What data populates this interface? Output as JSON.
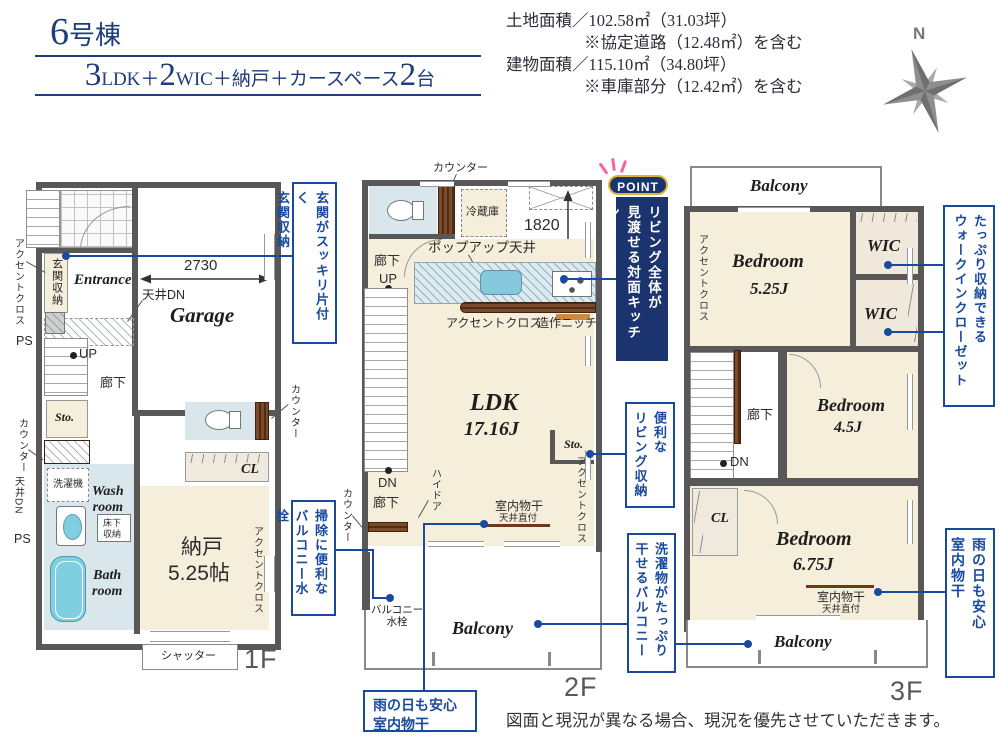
{
  "title": {
    "num": "6",
    "suffix": "号棟"
  },
  "plan": {
    "n1": "3",
    "t1": "LDK＋",
    "n2": "2",
    "t2": "WIC＋納戸＋カースペース",
    "n3": "2",
    "t3": "台"
  },
  "areas": {
    "land": "土地面積／102.58㎡（31.03坪）",
    "land_note": "※協定道路（12.48㎡）を含む",
    "bldg": "建物面積／115.10㎡（34.80坪）",
    "bldg_note": "※車庫部分（12.42㎡）を含む"
  },
  "compass": {
    "n": "N"
  },
  "f1": {
    "floor": "1F",
    "accent_entrance": "アクセントクロス",
    "genkan": "玄関収納",
    "entrance": "Entrance",
    "dim2730": "2730",
    "tenjo_dn": "天井DN",
    "garage": "Garage",
    "ps1": "PS",
    "up": "UP",
    "roka": "廊下",
    "sto": "Sto.",
    "counter_l": "カウンター",
    "counter_r": "カウンター",
    "tenjo_dn_l": "天井DN",
    "ps2": "PS",
    "sentakuki": "洗濯機",
    "wash": "Wash\nroom",
    "yukashita": "床下\n収納",
    "bath": "Bath\nroom",
    "cl": "CL",
    "nando": "納戸",
    "nando_size": "5.25帖",
    "accent_nando": "アクセントクロス",
    "shutter": "シャッター"
  },
  "f2": {
    "floor": "2F",
    "counter_t": "カウンター",
    "reizoko": "冷蔵庫",
    "dim1820": "1820",
    "popup": "ポップアップ天井",
    "roka_t": "廊下",
    "up": "UP",
    "accent_kitchen": "アクセントクロス",
    "niche": "造作ニッチ",
    "ldk": "LDK",
    "ldk_size": "17.16J",
    "sto": "Sto.",
    "accent_r": "アクセントクロス",
    "dn": "DN",
    "roka_b": "廊下",
    "counter_l": "カウンター",
    "hidoor": "ハイドア",
    "monohoshi": "室内物干",
    "tenjo": "天井直付",
    "suisen": "バルコニー\n水栓",
    "balcony": "Balcony"
  },
  "f3": {
    "floor": "3F",
    "balcony_t": "Balcony",
    "accent": "アクセントクロス",
    "bed1": "Bedroom",
    "bed1_size": "5.25J",
    "wic1": "WIC",
    "wic2": "WIC",
    "roka": "廊下",
    "dn": "DN",
    "bed2": "Bedroom",
    "bed2_size": "4.5J",
    "cl": "CL",
    "bed3": "Bedroom",
    "bed3_size": "6.75J",
    "monohoshi": "室内物干",
    "tenjo": "天井直付",
    "balcony_b": "Balcony"
  },
  "callouts": {
    "entrance": "玄関がスッキリ片付く\n玄関収納",
    "suisen": "掃除に便利な\nバルコニー水栓",
    "point_badge": "POINT",
    "point": "リビング全体が\n見渡せる対面キッチン",
    "living_sto": "便利な\nリビング収納",
    "laundry": "洗濯物がたっぷり\n干せるバルコニー",
    "rain2f": "雨の日も安心\n室内物干",
    "wic": "たっぷり収納できる\nウォークインクローゼット",
    "rain3f": "雨の日も安心\n室内物干"
  },
  "footer": "図面と現況が異なる場合、現況を優先させていただきます。"
}
